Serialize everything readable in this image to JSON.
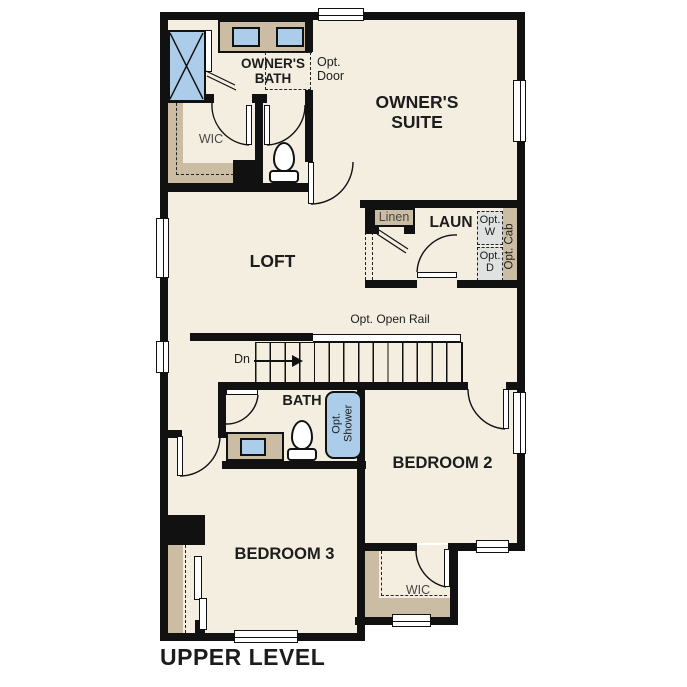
{
  "title": "UPPER LEVEL",
  "colors": {
    "floor": "#f4eee1",
    "wall": "#111111",
    "tan": "#cabda4",
    "fixture_blue": "#abcdea",
    "opt_gray": "#dfe2e0",
    "text": "#1c1c1c"
  },
  "rooms": {
    "owners_bath": "OWNER'S BATH",
    "owners_suite": "OWNER'S SUITE",
    "wic_owners": "WIC",
    "loft": "LOFT",
    "laundry": "LAUN",
    "bath": "BATH",
    "bedroom2": "BEDROOM 2",
    "bedroom3": "BEDROOM 3",
    "wic_bedroom2": "WIC"
  },
  "annotations": {
    "opt_door": "Opt. Door",
    "linen": "Linen",
    "opt_washer": "Opt. W",
    "opt_dryer": "Opt. D",
    "opt_cab": "Opt. Cab",
    "opt_open_rail": "Opt. Open Rail",
    "down": "Dn",
    "opt_shower": "Opt. Shower"
  }
}
